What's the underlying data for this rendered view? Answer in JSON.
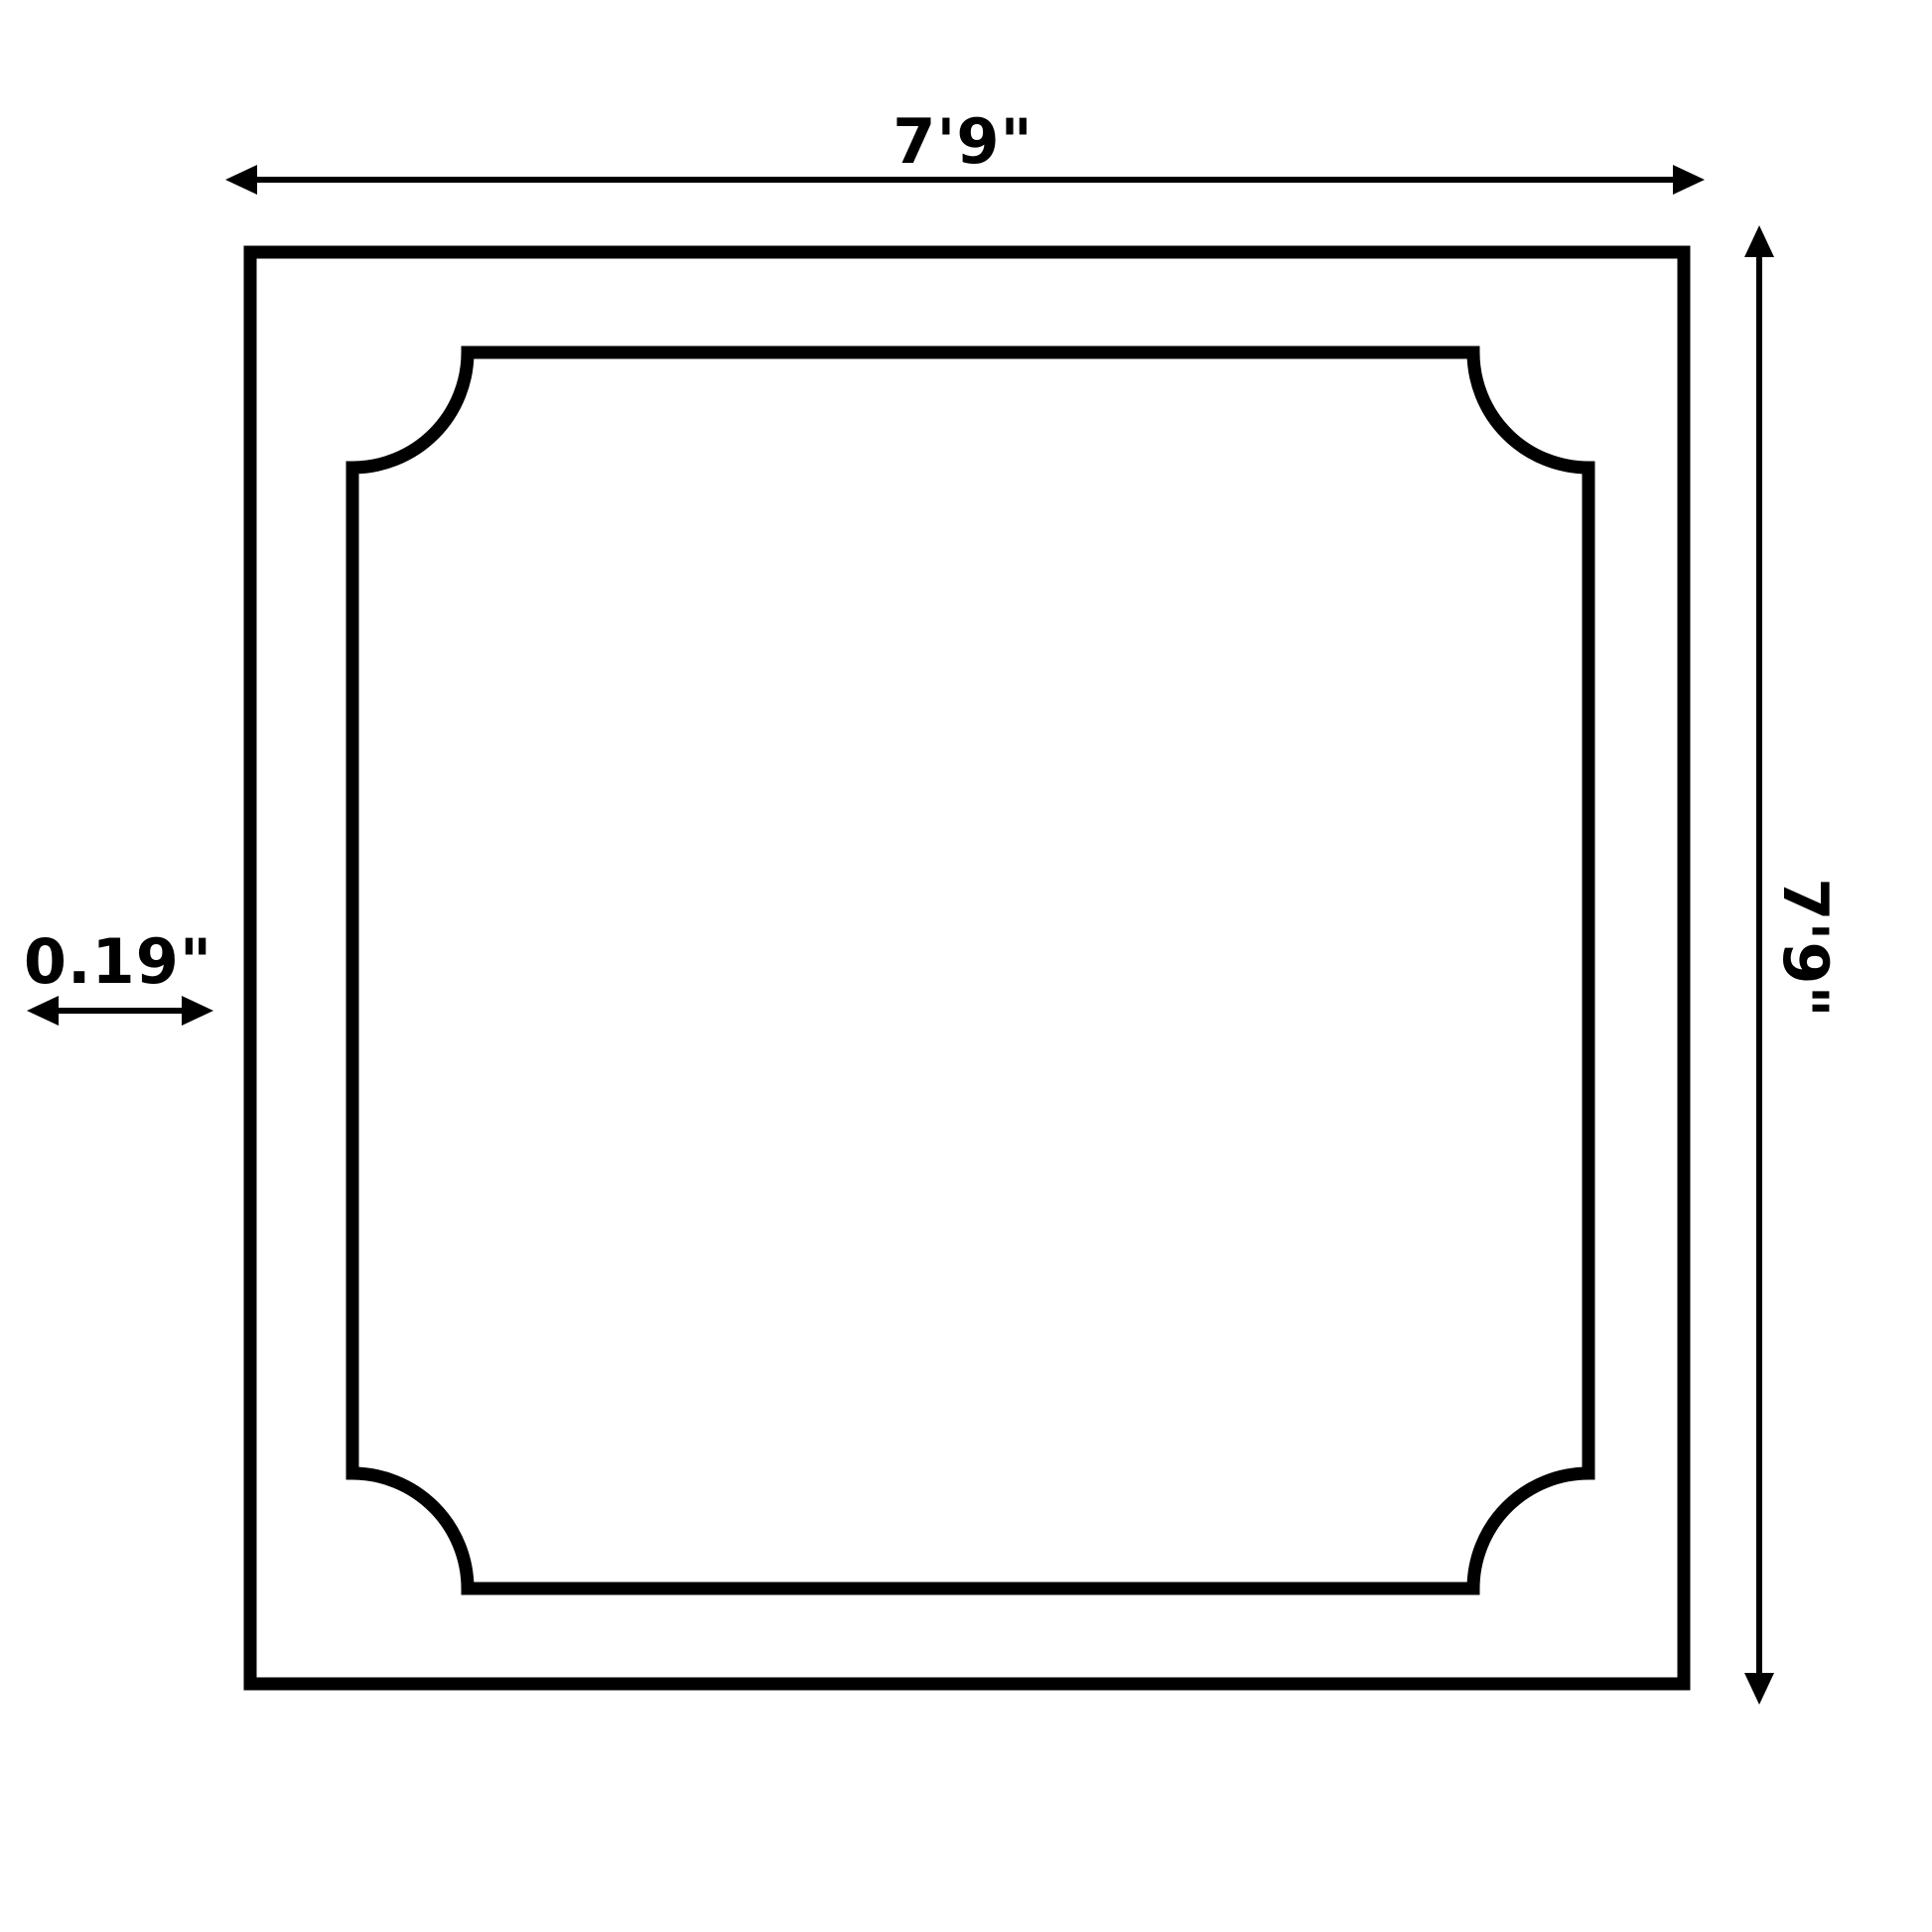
{
  "labels": {
    "width": "7'9\"",
    "height": "7'9\"",
    "thickness": "0.19\""
  },
  "colors": {
    "ink": "#000000",
    "paper": "#ffffff"
  },
  "icons": {
    "width_dimension": "double-headed-horizontal-arrow",
    "height_dimension": "double-headed-vertical-arrow",
    "thickness_dimension": "double-headed-horizontal-arrow"
  }
}
